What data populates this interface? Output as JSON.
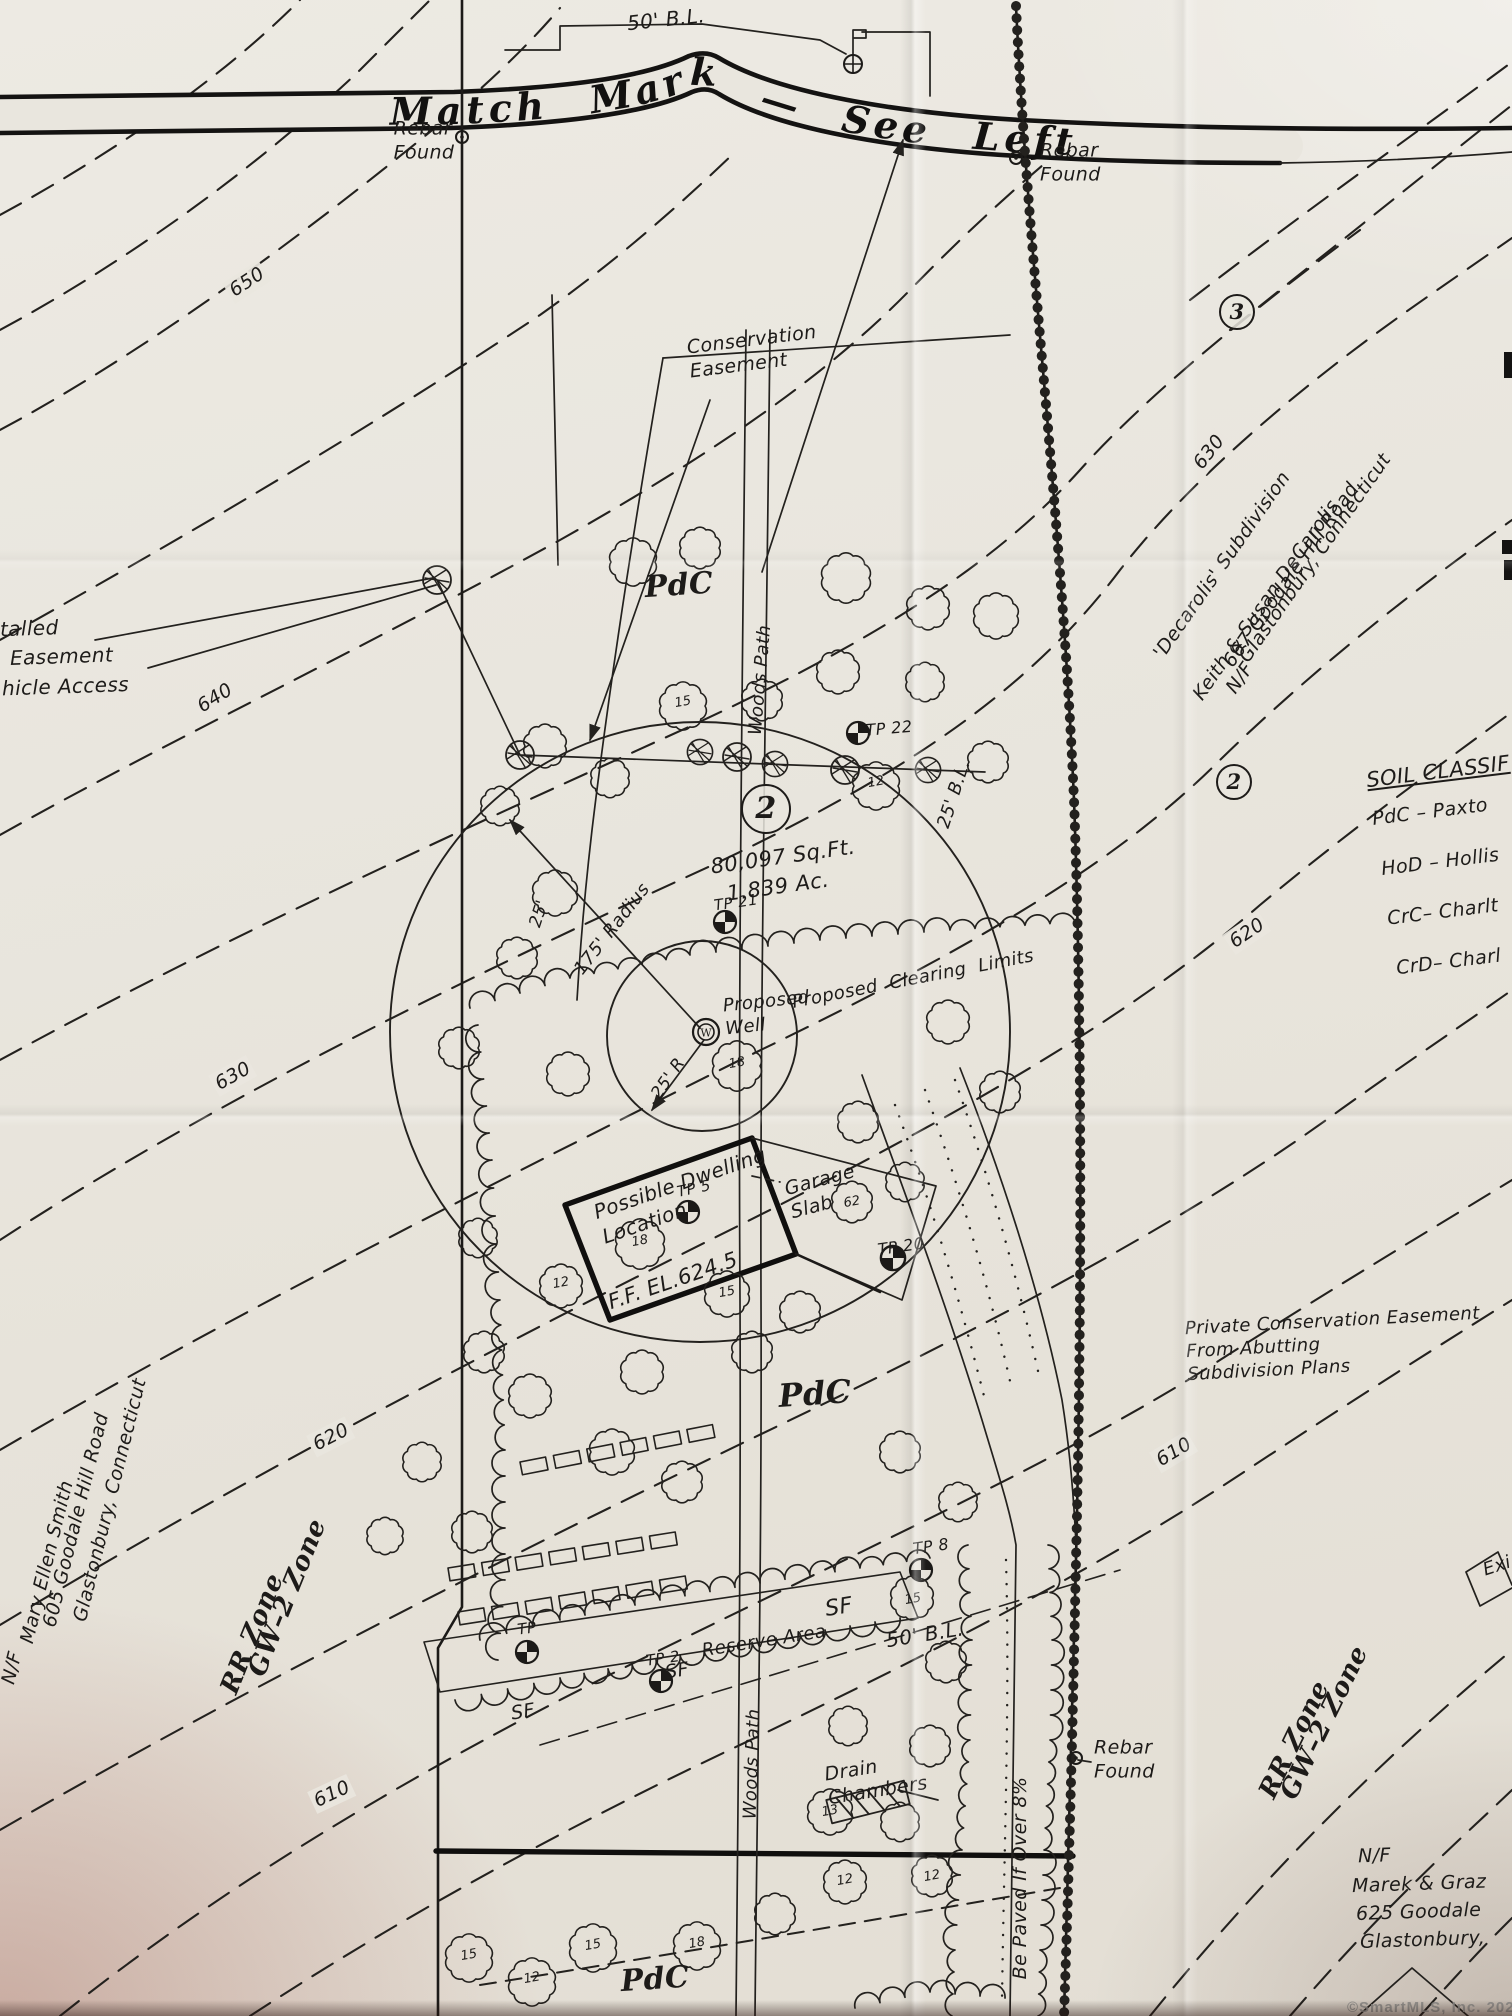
{
  "banner": {
    "text": "Match Mark — See Left"
  },
  "watermark": {
    "text": "©SmartMLS, Inc. 2025"
  },
  "label_groups": {
    "boundary_markers": [
      {
        "n": "label-building-line-top",
        "t": "50' B.L.",
        "x": 666,
        "y": 20,
        "r": -6,
        "s": 20
      },
      {
        "n": "label-rebar-found-nw",
        "t": "Rebar\nFound",
        "x": 424,
        "y": 141,
        "r": 0,
        "s": 19
      },
      {
        "n": "label-rebar-found-ne",
        "t": "Rebar\nFound",
        "x": 1040,
        "y": 163,
        "r": 0,
        "s": 19,
        "a": "l"
      },
      {
        "n": "label-rebar-found-se",
        "t": "Rebar\nFound",
        "x": 1094,
        "y": 1760,
        "r": 0,
        "s": 19,
        "a": "l"
      },
      {
        "n": "label-building-line-25",
        "t": "25' B.L.",
        "x": 954,
        "y": 794,
        "r": -72,
        "s": 18
      },
      {
        "n": "label-building-line-mid",
        "t": "50' B.L.",
        "x": 925,
        "y": 1635,
        "r": -9,
        "s": 20
      }
    ],
    "contour_elevations": [
      {
        "n": "contour-650",
        "t": "650",
        "x": 247,
        "y": 282,
        "r": -33,
        "s": 19,
        "c": "gap"
      },
      {
        "n": "contour-640",
        "t": "640",
        "x": 215,
        "y": 698,
        "r": -32,
        "s": 19,
        "c": "gap"
      },
      {
        "n": "contour-630-w",
        "t": "630",
        "x": 233,
        "y": 1076,
        "r": -29,
        "s": 19,
        "c": "gap"
      },
      {
        "n": "contour-620-w",
        "t": "620",
        "x": 331,
        "y": 1437,
        "r": -27,
        "s": 19,
        "c": "gap"
      },
      {
        "n": "contour-610-w",
        "t": "610",
        "x": 332,
        "y": 1794,
        "r": -25,
        "s": 19,
        "c": "gap"
      },
      {
        "n": "contour-630-e",
        "t": "630",
        "x": 1209,
        "y": 452,
        "r": -52,
        "s": 19,
        "c": "gap"
      },
      {
        "n": "contour-620-e",
        "t": "620",
        "x": 1247,
        "y": 933,
        "r": -34,
        "s": 19,
        "c": "gap"
      },
      {
        "n": "contour-610-e",
        "t": "610",
        "x": 1174,
        "y": 1452,
        "r": -31,
        "s": 19,
        "c": "gap"
      }
    ],
    "lot_info": [
      {
        "n": "lot-number-2",
        "t": "2",
        "x": 766,
        "y": 809,
        "w": 46,
        "h": 46,
        "s": 30,
        "c": "circled"
      },
      {
        "n": "label-lot-area-sqft",
        "t": "80,097 Sq.Ft.",
        "x": 783,
        "y": 857,
        "r": -8,
        "s": 21
      },
      {
        "n": "label-lot-area-acres",
        "t": "1.839 Ac.",
        "x": 778,
        "y": 887,
        "r": -8,
        "s": 21
      },
      {
        "n": "lot-number-3-circle",
        "t": "3",
        "x": 1237,
        "y": 312,
        "w": 32,
        "h": 32,
        "s": 21,
        "c": "circled"
      },
      {
        "n": "lot-number-2-circle-east",
        "t": "2",
        "x": 1234,
        "y": 782,
        "w": 32,
        "h": 32,
        "s": 21,
        "c": "circled"
      }
    ],
    "site_features": [
      {
        "n": "label-conservation-easement",
        "t": "Conservation\nEasement",
        "x": 688,
        "y": 352,
        "r": -7,
        "s": 19,
        "a": "l"
      },
      {
        "n": "label-soil-pdc-north",
        "t": "PdC",
        "x": 679,
        "y": 586,
        "r": -4,
        "s": 30,
        "c": "serif"
      },
      {
        "n": "label-soil-pdc-mid",
        "t": "PdC",
        "x": 815,
        "y": 1394,
        "r": -4,
        "s": 32,
        "c": "serif"
      },
      {
        "n": "label-soil-pdc-south",
        "t": "PdC",
        "x": 655,
        "y": 1980,
        "r": -4,
        "s": 30,
        "c": "serif"
      },
      {
        "n": "label-woods-path-north",
        "t": "Woods Path",
        "x": 760,
        "y": 680,
        "r": -85,
        "s": 18
      },
      {
        "n": "label-woods-path-south",
        "t": "Woods Path",
        "x": 752,
        "y": 1764,
        "r": -88,
        "s": 18
      },
      {
        "n": "label-radius-175",
        "t": "175' Radius",
        "x": 612,
        "y": 929,
        "r": -52,
        "s": 18
      },
      {
        "n": "label-offset-25",
        "t": "25'",
        "x": 540,
        "y": 914,
        "r": -72,
        "s": 17
      },
      {
        "n": "label-radius-25",
        "t": "25' R",
        "x": 669,
        "y": 1079,
        "r": -55,
        "s": 17
      },
      {
        "n": "label-proposed-clearing-limits",
        "t": "Proposed  Clearing  Limits",
        "x": 913,
        "y": 979,
        "r": -11,
        "s": 18
      },
      {
        "n": "label-proposed-well",
        "t": "Proposed\nWell",
        "x": 724,
        "y": 1013,
        "r": -6,
        "s": 18,
        "a": "l"
      },
      {
        "n": "label-possible-dwelling",
        "t": "Possible Dwelling\nLocation",
        "x": 594,
        "y": 1196,
        "r": -19,
        "s": 20,
        "a": "l"
      },
      {
        "n": "label-garage-slab",
        "t": "Garage\nSlab",
        "x": 787,
        "y": 1192,
        "r": -15,
        "s": 19,
        "a": "l"
      },
      {
        "n": "label-finished-floor",
        "t": "F.F. EL.624.5",
        "x": 673,
        "y": 1281,
        "r": -19,
        "s": 21
      },
      {
        "n": "label-reserve-area",
        "t": "Reserve Area",
        "x": 764,
        "y": 1641,
        "r": -9,
        "s": 18
      },
      {
        "n": "label-sf-1",
        "t": "SF",
        "x": 523,
        "y": 1712,
        "r": -9,
        "s": 19
      },
      {
        "n": "label-sf-2",
        "t": "SF",
        "x": 677,
        "y": 1671,
        "r": -9,
        "s": 19
      },
      {
        "n": "label-sf-3",
        "t": "SF",
        "x": 839,
        "y": 1608,
        "r": -9,
        "s": 22
      },
      {
        "n": "label-drain-chambers",
        "t": "Drain\nChambers",
        "x": 826,
        "y": 1779,
        "r": -9,
        "s": 19,
        "a": "l"
      },
      {
        "n": "label-be-paved",
        "t": "Be Paved If Over 8%",
        "x": 1020,
        "y": 1878,
        "r": -90,
        "s": 19
      },
      {
        "n": "label-private-conservation-easement",
        "t": "Private Conservation Easement\nFrom Abutting\nSubdivision Plans",
        "x": 1186,
        "y": 1344,
        "r": -3,
        "s": 18,
        "a": "l"
      }
    ],
    "test_pits": [
      {
        "n": "label-tp-22",
        "t": "TP 22",
        "x": 889,
        "y": 729,
        "r": -5,
        "s": 16
      },
      {
        "n": "label-tp-21",
        "t": "TP 21",
        "x": 736,
        "y": 903,
        "r": -8,
        "s": 15
      },
      {
        "n": "label-tp-5",
        "t": "TP 5",
        "x": 694,
        "y": 1189,
        "r": -12,
        "s": 15
      },
      {
        "n": "label-tp-20",
        "t": "TP 20",
        "x": 901,
        "y": 1247,
        "r": -8,
        "s": 16
      },
      {
        "n": "label-tp-8",
        "t": "TP 8",
        "x": 931,
        "y": 1547,
        "r": -8,
        "s": 16
      },
      {
        "n": "label-tp-1",
        "t": "TP",
        "x": 527,
        "y": 1629,
        "r": -8,
        "s": 15
      },
      {
        "n": "label-tp-2",
        "t": "TP 2",
        "x": 663,
        "y": 1659,
        "r": -8,
        "s": 15
      }
    ],
    "soil_legend": [
      {
        "n": "legend-title",
        "t": "SOIL CLASSIF",
        "x": 1366,
        "y": 772,
        "r": -7,
        "s": 21,
        "a": "l",
        "c": "u"
      },
      {
        "n": "legend-item-pdc",
        "t": "PdC – Paxto",
        "x": 1372,
        "y": 812,
        "r": -7,
        "s": 19,
        "a": "l"
      },
      {
        "n": "legend-item-hod",
        "t": "HoD – Hollis",
        "x": 1381,
        "y": 862,
        "r": -7,
        "s": 19,
        "a": "l"
      },
      {
        "n": "legend-item-crc",
        "t": "CrC– Charlt",
        "x": 1387,
        "y": 912,
        "r": -7,
        "s": 19,
        "a": "l"
      },
      {
        "n": "legend-item-crd",
        "t": "CrD– Charl",
        "x": 1396,
        "y": 962,
        "r": -7,
        "s": 19,
        "a": "l"
      }
    ],
    "abutters": [
      {
        "n": "label-decarolis-subdivision",
        "t": "'Decarolis' Subdivision",
        "x": 1222,
        "y": 565,
        "r": -55,
        "s": 19
      },
      {
        "n": "label-nf-east",
        "t": "N/F",
        "x": 1240,
        "y": 678,
        "r": -55,
        "s": 19
      },
      {
        "n": "label-keith-susan-decarolis",
        "t": "Keith & Susan DeCarolis",
        "x": 1266,
        "y": 600,
        "r": -55,
        "s": 19
      },
      {
        "n": "label-667-goodale",
        "t": "667 Goodale Hill Road",
        "x": 1291,
        "y": 575,
        "r": -55,
        "s": 19
      },
      {
        "n": "label-glastonbury-east",
        "t": "Glastonbury, Connecticut",
        "x": 1315,
        "y": 558,
        "r": -55,
        "s": 19
      },
      {
        "n": "label-nf-west",
        "t": "N/F",
        "x": 12,
        "y": 1668,
        "r": -76,
        "s": 19
      },
      {
        "n": "label-mary-ellen-smith",
        "t": "Mary Ellen Smith",
        "x": 47,
        "y": 1562,
        "r": -76,
        "s": 19
      },
      {
        "n": "label-605-goodale",
        "t": "605 Goodale Hill Road",
        "x": 76,
        "y": 1520,
        "r": -76,
        "s": 19
      },
      {
        "n": "label-glastonbury-west",
        "t": "Glastonbury, Connecticut",
        "x": 110,
        "y": 1500,
        "r": -76,
        "s": 19
      },
      {
        "n": "label-nf-south",
        "t": "N/F",
        "x": 1358,
        "y": 1856,
        "r": -2,
        "s": 19,
        "a": "l"
      },
      {
        "n": "label-marek",
        "t": "Marek & Graz",
        "x": 1352,
        "y": 1884,
        "r": -2,
        "s": 19,
        "a": "l"
      },
      {
        "n": "label-625-goodale",
        "t": "625 Goodale",
        "x": 1356,
        "y": 1912,
        "r": -2,
        "s": 19,
        "a": "l"
      },
      {
        "n": "label-glastonbury-south",
        "t": "Glastonbury,",
        "x": 1360,
        "y": 1940,
        "r": -2,
        "s": 19,
        "a": "l"
      }
    ],
    "zones": [
      {
        "n": "label-rr-zone-west",
        "t": "RR Zone",
        "x": 253,
        "y": 1634,
        "r": -68,
        "s": 26,
        "c": "serif"
      },
      {
        "n": "label-gw2-zone-west",
        "t": "GW–2 Zone",
        "x": 288,
        "y": 1598,
        "r": -68,
        "s": 26,
        "c": "serif"
      },
      {
        "n": "label-rr-zone-east",
        "t": "RR Zone",
        "x": 1295,
        "y": 1740,
        "r": -64,
        "s": 26,
        "c": "serif"
      },
      {
        "n": "label-gw2-zone-east",
        "t": "GW–2 Zone",
        "x": 1325,
        "y": 1723,
        "r": -64,
        "s": 26,
        "c": "serif"
      }
    ],
    "edge_fragments": [
      {
        "n": "fragment-talled",
        "t": "talled",
        "x": 0,
        "y": 629,
        "r": -2,
        "s": 20,
        "a": "l"
      },
      {
        "n": "fragment-easement",
        "t": "Easement",
        "x": 10,
        "y": 657,
        "r": -2,
        "s": 20,
        "a": "l"
      },
      {
        "n": "fragment-vehicle-access",
        "t": "hicle Access",
        "x": 2,
        "y": 687,
        "r": -2,
        "s": 20,
        "a": "l"
      },
      {
        "n": "fragment-existing-box",
        "t": "Exi",
        "x": 1497,
        "y": 1566,
        "r": -18,
        "s": 18
      }
    ],
    "tree_sizes": [
      {
        "n": "tree-size",
        "t": "12",
        "x": 876,
        "y": 783,
        "r": -10,
        "s": 13,
        "c": "tn"
      },
      {
        "n": "tree-size",
        "t": "18",
        "x": 737,
        "y": 1064,
        "r": -10,
        "s": 13,
        "c": "tn"
      },
      {
        "n": "tree-size",
        "t": "18",
        "x": 640,
        "y": 1242,
        "r": -10,
        "s": 13,
        "c": "tn"
      },
      {
        "n": "tree-size",
        "t": "12",
        "x": 561,
        "y": 1284,
        "r": -10,
        "s": 13,
        "c": "tn"
      },
      {
        "n": "tree-size",
        "t": "15",
        "x": 727,
        "y": 1293,
        "r": -10,
        "s": 13,
        "c": "tn"
      },
      {
        "n": "tree-size",
        "t": "62",
        "x": 852,
        "y": 1203,
        "r": -10,
        "s": 13,
        "c": "tn"
      },
      {
        "n": "tree-size",
        "t": "13",
        "x": 830,
        "y": 1812,
        "r": -10,
        "s": 13,
        "c": "tn"
      },
      {
        "n": "tree-size",
        "t": "12",
        "x": 845,
        "y": 1881,
        "r": -10,
        "s": 13,
        "c": "tn"
      },
      {
        "n": "tree-size",
        "t": "12",
        "x": 932,
        "y": 1877,
        "r": -10,
        "s": 13,
        "c": "tn"
      },
      {
        "n": "tree-size",
        "t": "15",
        "x": 913,
        "y": 1600,
        "r": -10,
        "s": 13,
        "c": "tn"
      },
      {
        "n": "tree-size",
        "t": "15",
        "x": 469,
        "y": 1956,
        "r": -10,
        "s": 13,
        "c": "tn"
      },
      {
        "n": "tree-size",
        "t": "12",
        "x": 532,
        "y": 1979,
        "r": -10,
        "s": 13,
        "c": "tn"
      },
      {
        "n": "tree-size",
        "t": "15",
        "x": 593,
        "y": 1946,
        "r": -10,
        "s": 13,
        "c": "tn"
      },
      {
        "n": "tree-size",
        "t": "18",
        "x": 697,
        "y": 1944,
        "r": -10,
        "s": 13,
        "c": "tn"
      },
      {
        "n": "tree-size",
        "t": "15",
        "x": 683,
        "y": 703,
        "r": -10,
        "s": 13,
        "c": "tn"
      }
    ]
  }
}
